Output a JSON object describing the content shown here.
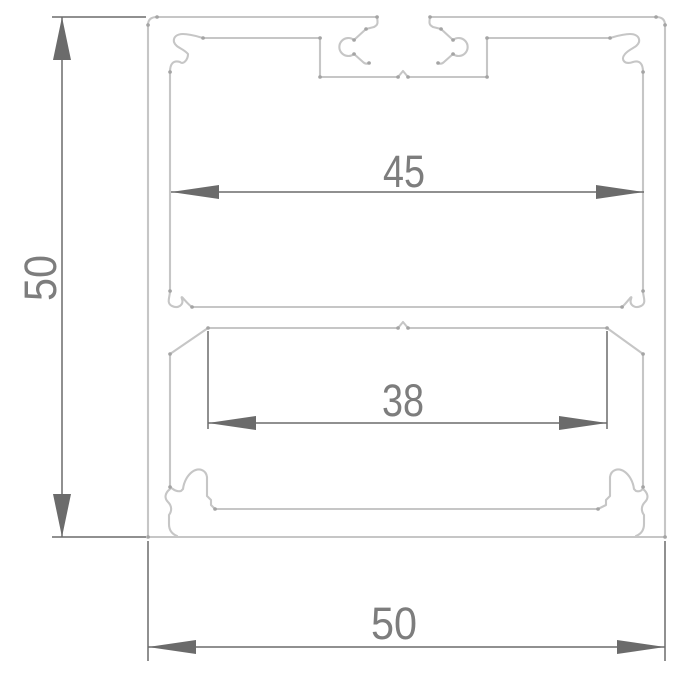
{
  "drawing": {
    "kind": "extrusion-profile-cross-section",
    "dimensions": {
      "overall_height": "50",
      "inner_top_width": "45",
      "inner_bottom_width": "38",
      "overall_width": "50"
    },
    "colors": {
      "background": "#ffffff",
      "profile_line": "#c6c6c6",
      "vertex_dot": "#a4a4a4",
      "dimension_line": "#6b6b6b",
      "dimension_text": "#7d7d7d"
    }
  }
}
